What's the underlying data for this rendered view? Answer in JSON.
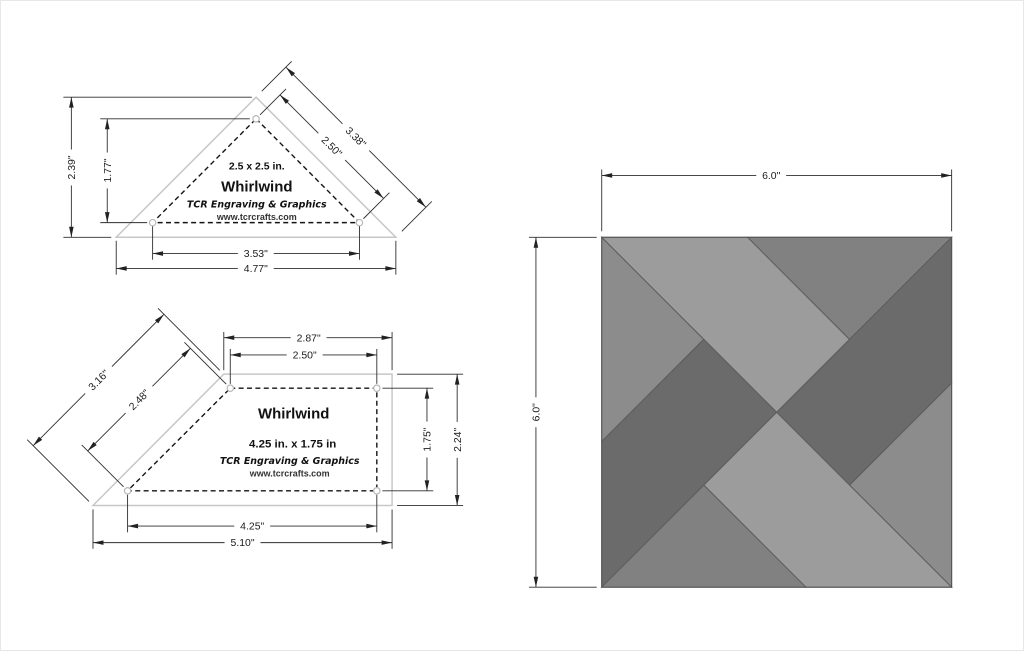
{
  "template_triangle": {
    "labels": {
      "size": "2.5 x 2.5 in.",
      "name": "Whirlwind",
      "brand": "TCR Engraving & Graphics",
      "website": "www.tcrcrafts.com"
    },
    "dims": {
      "outer_height": "2.39\"",
      "inner_height": "1.77\"",
      "outer_edge": "3.38\"",
      "inner_edge": "2.50\"",
      "inner_base": "3.53\"",
      "outer_base": "4.77\""
    }
  },
  "template_trapezoid": {
    "labels": {
      "name": "Whirlwind",
      "size": "4.25 in. x 1.75 in",
      "brand": "TCR Engraving & Graphics",
      "website": "www.tcrcrafts.com"
    },
    "dims": {
      "outer_top": "2.87\"",
      "inner_top": "2.50\"",
      "outer_slant": "3.16\"",
      "inner_slant": "2.48\"",
      "inner_right": "1.75\"",
      "outer_right": "2.24\"",
      "inner_bottom": "4.25\"",
      "outer_bottom": "5.10\""
    }
  },
  "block_preview": {
    "width_label": "6.0\"",
    "height_label": "6.0\"",
    "colors": {
      "light": "#9c9c9c",
      "medium_light": "#8c8c8c",
      "medium_dark": "#818181",
      "dark": "#6b6b6b"
    }
  }
}
